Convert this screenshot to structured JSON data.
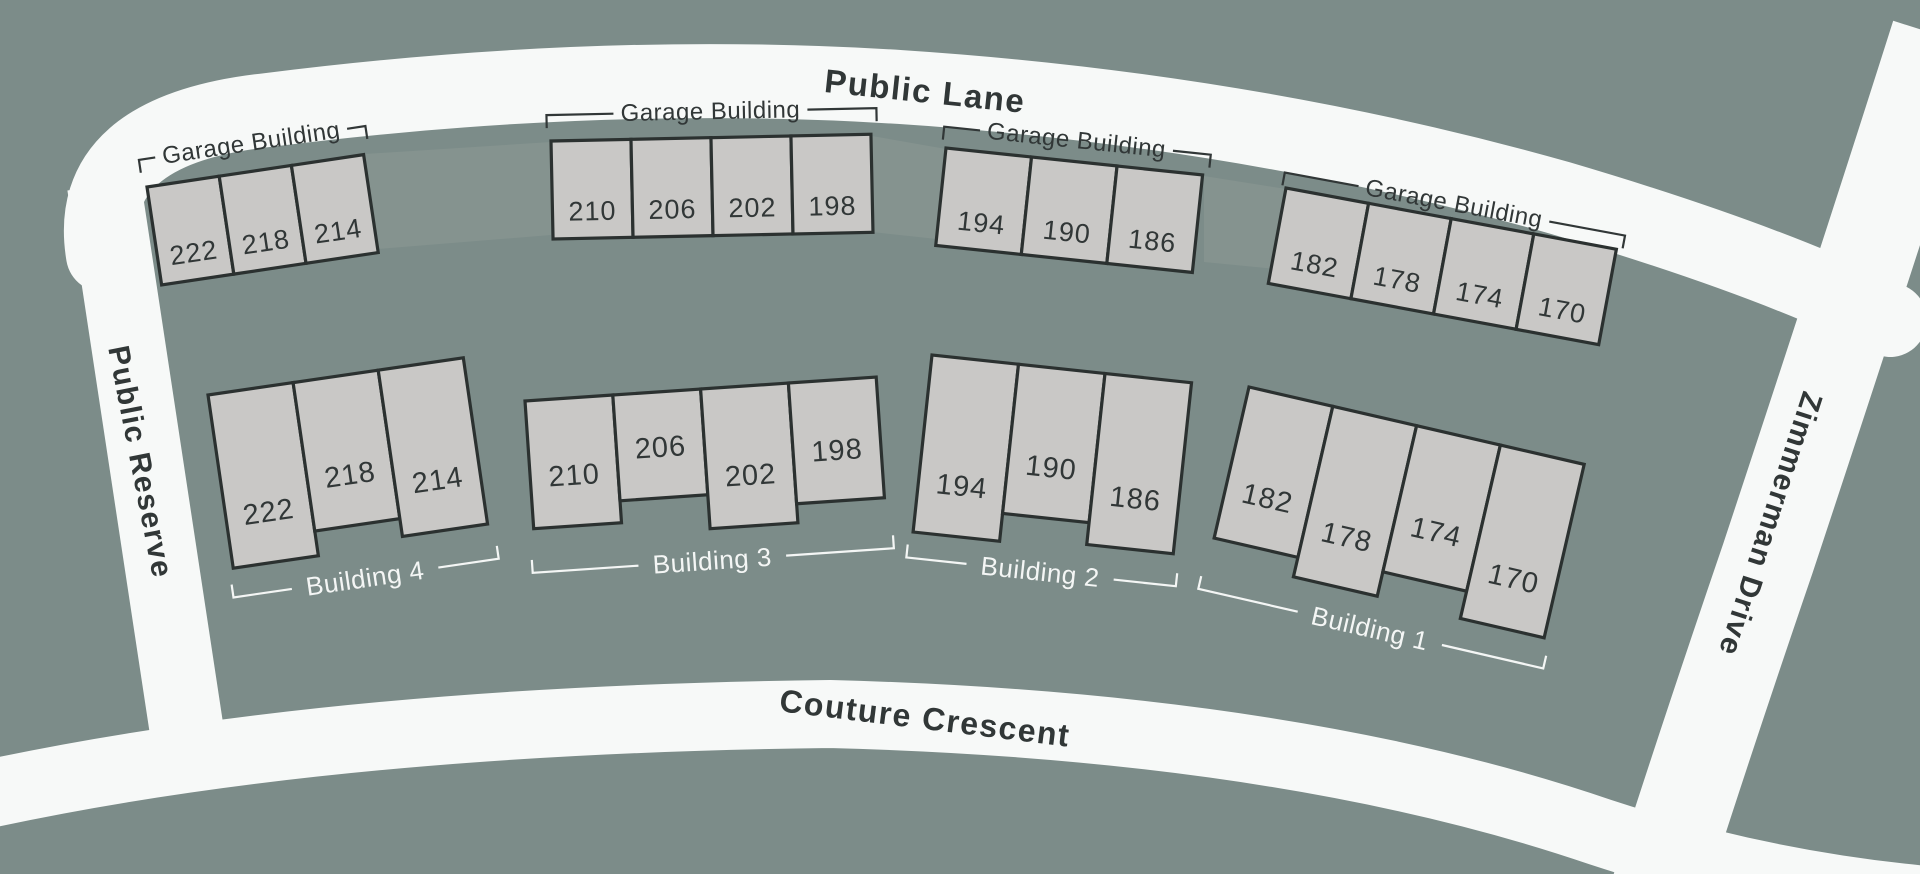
{
  "colors": {
    "background": "#7C8C89",
    "road": "#F7F9F8",
    "unit_fill": "#C9C8C6",
    "unit_outline": "#2B3130",
    "dark_text": "#313737",
    "light_text": "#F4F6F5",
    "driveway": "#85938F"
  },
  "streets": [
    {
      "name": "Public Lane"
    },
    {
      "name": "Public Reserve"
    },
    {
      "name": "Couture Crescent"
    },
    {
      "name": "Zimmerman Drive"
    }
  ],
  "garages": [
    {
      "label": "Garage Building",
      "units": [
        "222",
        "218",
        "214"
      ]
    },
    {
      "label": "Garage Building",
      "units": [
        "210",
        "206",
        "202",
        "198"
      ]
    },
    {
      "label": "Garage Building",
      "units": [
        "194",
        "190",
        "186"
      ]
    },
    {
      "label": "Garage Building",
      "units": [
        "182",
        "178",
        "174",
        "170"
      ]
    }
  ],
  "buildings": [
    {
      "label": "Building 4",
      "units": [
        "222",
        "218",
        "214"
      ]
    },
    {
      "label": "Building 3",
      "units": [
        "210",
        "206",
        "202",
        "198"
      ]
    },
    {
      "label": "Building 2",
      "units": [
        "194",
        "190",
        "186"
      ]
    },
    {
      "label": "Building 1",
      "units": [
        "182",
        "178",
        "174",
        "170"
      ]
    }
  ]
}
